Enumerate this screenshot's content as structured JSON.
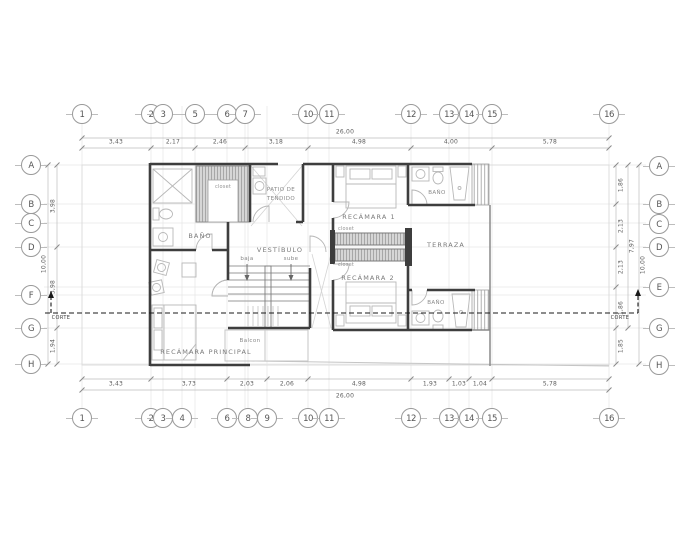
{
  "grid_bubbles": {
    "top": [
      "1",
      "2",
      "3",
      "5",
      "6",
      "7",
      "10",
      "11",
      "12",
      "13",
      "14",
      "15",
      "16"
    ],
    "bottom": [
      "1",
      "2",
      "3",
      "4",
      "6",
      "8",
      "9",
      "10",
      "11",
      "12",
      "13",
      "14",
      "15",
      "16"
    ],
    "left": [
      "A",
      "B",
      "C",
      "D",
      "F",
      "G",
      "H"
    ],
    "right": [
      "A",
      "B",
      "C",
      "D",
      "E",
      "G",
      "H"
    ]
  },
  "dimensions": {
    "top": {
      "overall": "26,00",
      "segments": [
        "3,43",
        "2,17",
        "2,46",
        "3,18",
        "4,98",
        "4,00",
        "5,78"
      ]
    },
    "bottom": {
      "overall": "26,00",
      "segments": [
        "3,43",
        "3,73",
        "2,03",
        "2,06",
        "4,98",
        "1,93",
        "1,03",
        "1,04",
        "5,78"
      ]
    },
    "left": {
      "overall": "10,00",
      "segments": [
        "3,98",
        "3,98",
        "1,94"
      ]
    },
    "right": {
      "overall": "10,00",
      "span": "7,97",
      "segments": [
        "1,86",
        "2,13",
        "2,13",
        "1,86",
        "1,85"
      ]
    }
  },
  "rooms": {
    "bano_left": "BAÑO",
    "patio_line1": "PATIO DE",
    "patio_line2": "TENDIDO",
    "recamara_1": "RECÁMARA 1",
    "bano_top": "BAÑO",
    "vestibulo": "VESTÍBULO",
    "terraza": "TERRAZA",
    "recamara_2": "RECÁMARA 2",
    "bano_bottom": "BAÑO",
    "recamara_principal": "RECÁMARA PRINCIPAL",
    "balcon": "Balcon"
  },
  "annotations": {
    "closet_bath": "closet",
    "closet_upper": "closet",
    "closet_lower": "closet",
    "stair_down": "baja",
    "stair_up": "sube",
    "section_left": "CORTE",
    "section_right": "CORTE"
  },
  "colors": {
    "wall": "#3e3e3e",
    "hatch_fill": "#d6d6d6",
    "dim_line": "#b8b8b8",
    "section_line": "#1a1a1a",
    "text": "#7a7a7a"
  }
}
